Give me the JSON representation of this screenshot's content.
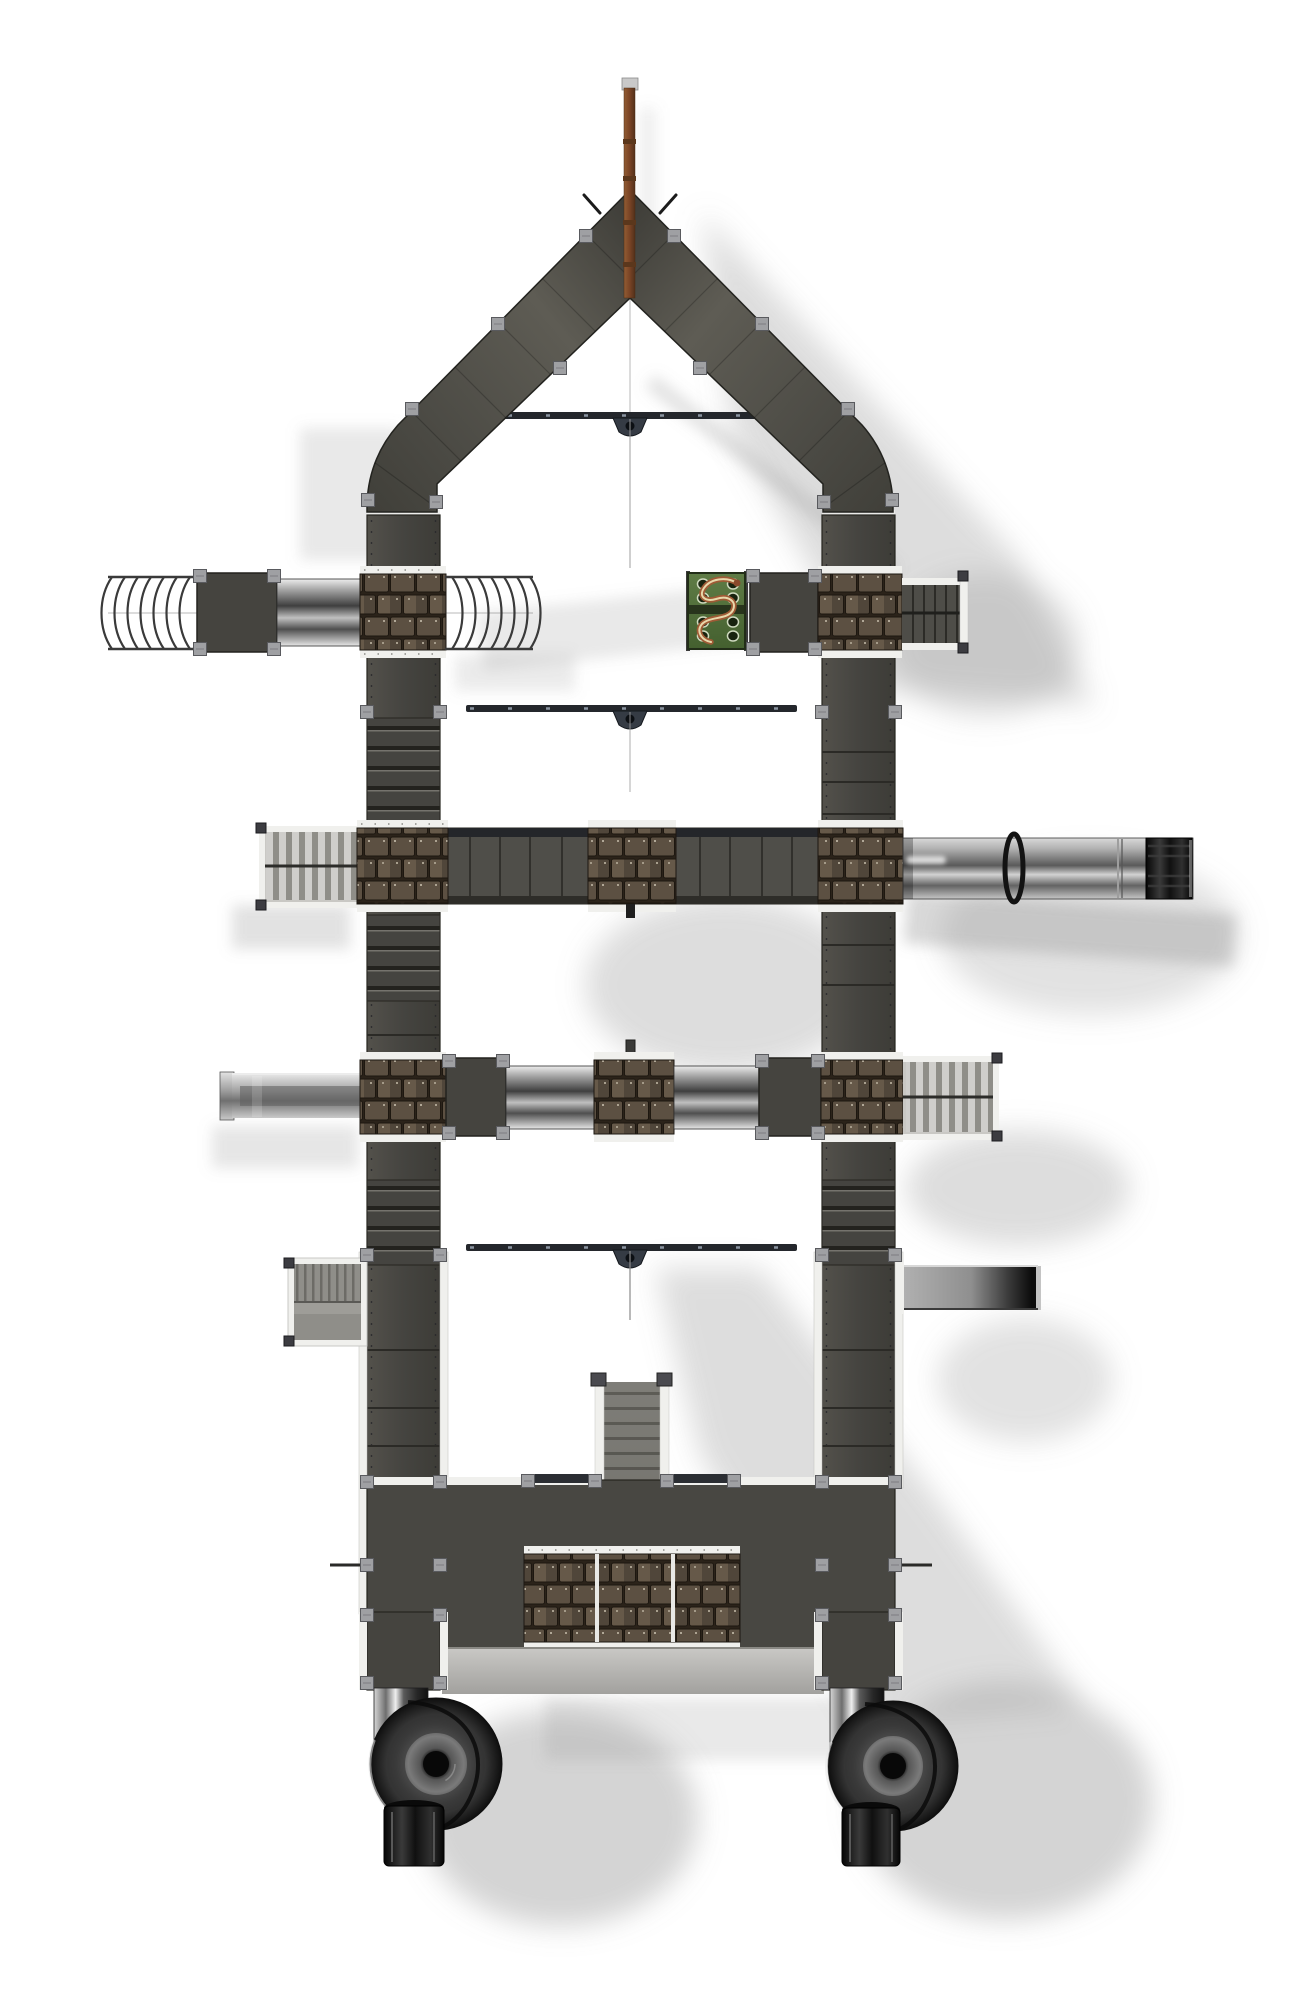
{
  "scene": {
    "type": "3d-render",
    "subject": "playground tower with spiral tube slides, top-down orthographic view",
    "background": "#ffffff"
  },
  "colors": {
    "panel": "#45443f",
    "deck": "#4f4e49",
    "band": "#484742",
    "slat_bg": "#c9c8c4",
    "chute_gray": "#8f8e89",
    "rail_white": "#f0f0ed",
    "clip_gray": "#9fa0a3",
    "shingle_brown": "#5a4e40",
    "shingle_gap": "#241d15",
    "steel_light": "#e9e9e9",
    "steel_dark": "#3e3e3e",
    "slide_tube_black": "#141414",
    "green_panel": "#4f6b39",
    "snake_red": "#a05a36",
    "mast_brown": "#7b4526",
    "beam_navy": "#24272c",
    "shadow_gray": "#8f8f8f",
    "recess_gray": "#b5b4b1"
  },
  "components": [
    {
      "id": "mast",
      "label": "rooftop mast"
    },
    {
      "id": "gable-roof",
      "label": "pointed gable roof"
    },
    {
      "id": "left-wall",
      "label": "west walkway wall"
    },
    {
      "id": "right-wall",
      "label": "east walkway wall"
    },
    {
      "id": "swing-beam-1",
      "label": "swing beam with trapeze"
    },
    {
      "id": "swing-beam-2",
      "label": "swing beam with trapeze"
    },
    {
      "id": "swing-beam-3",
      "label": "swing beam with trapeze"
    },
    {
      "id": "net-tunnel-west",
      "label": "flexible ring tunnel"
    },
    {
      "id": "net-tunnel-inner",
      "label": "flexible ring tunnel"
    },
    {
      "id": "crawl-tube-west",
      "label": "steel crawl tube"
    },
    {
      "id": "snake-climb-panel",
      "label": "green snake climbing panel"
    },
    {
      "id": "stair-bridge-east",
      "label": "stepped bridge"
    },
    {
      "id": "palisade-bridge-west",
      "label": "slatted palisade bridge"
    },
    {
      "id": "bridge-deck",
      "label": "long bridge deck"
    },
    {
      "id": "long-crawl-tube-east",
      "label": "long steel tunnel with clamp ring"
    },
    {
      "id": "slide-chute-west",
      "label": "straight slide chute"
    },
    {
      "id": "slide-chute-east",
      "label": "straight slide chute"
    },
    {
      "id": "palisade-bridge-east",
      "label": "slatted palisade bridge"
    },
    {
      "id": "ramp-west",
      "label": "ribbed access ramp"
    },
    {
      "id": "center-staircase",
      "label": "central staircase"
    },
    {
      "id": "base-deck",
      "label": "base deck with shingle cladding"
    },
    {
      "id": "spiral-slide-west",
      "label": "spiral tube slide"
    },
    {
      "id": "spiral-slide-east",
      "label": "spiral tube slide"
    },
    {
      "id": "shingle-cladding",
      "label": "wood shingle cladding panel"
    }
  ],
  "counts": {
    "swing_beams": 3,
    "spiral_slides": 2,
    "shingle_panels": 10,
    "net_tunnels": 2,
    "steel_tubes": 4,
    "platforms": 4
  }
}
